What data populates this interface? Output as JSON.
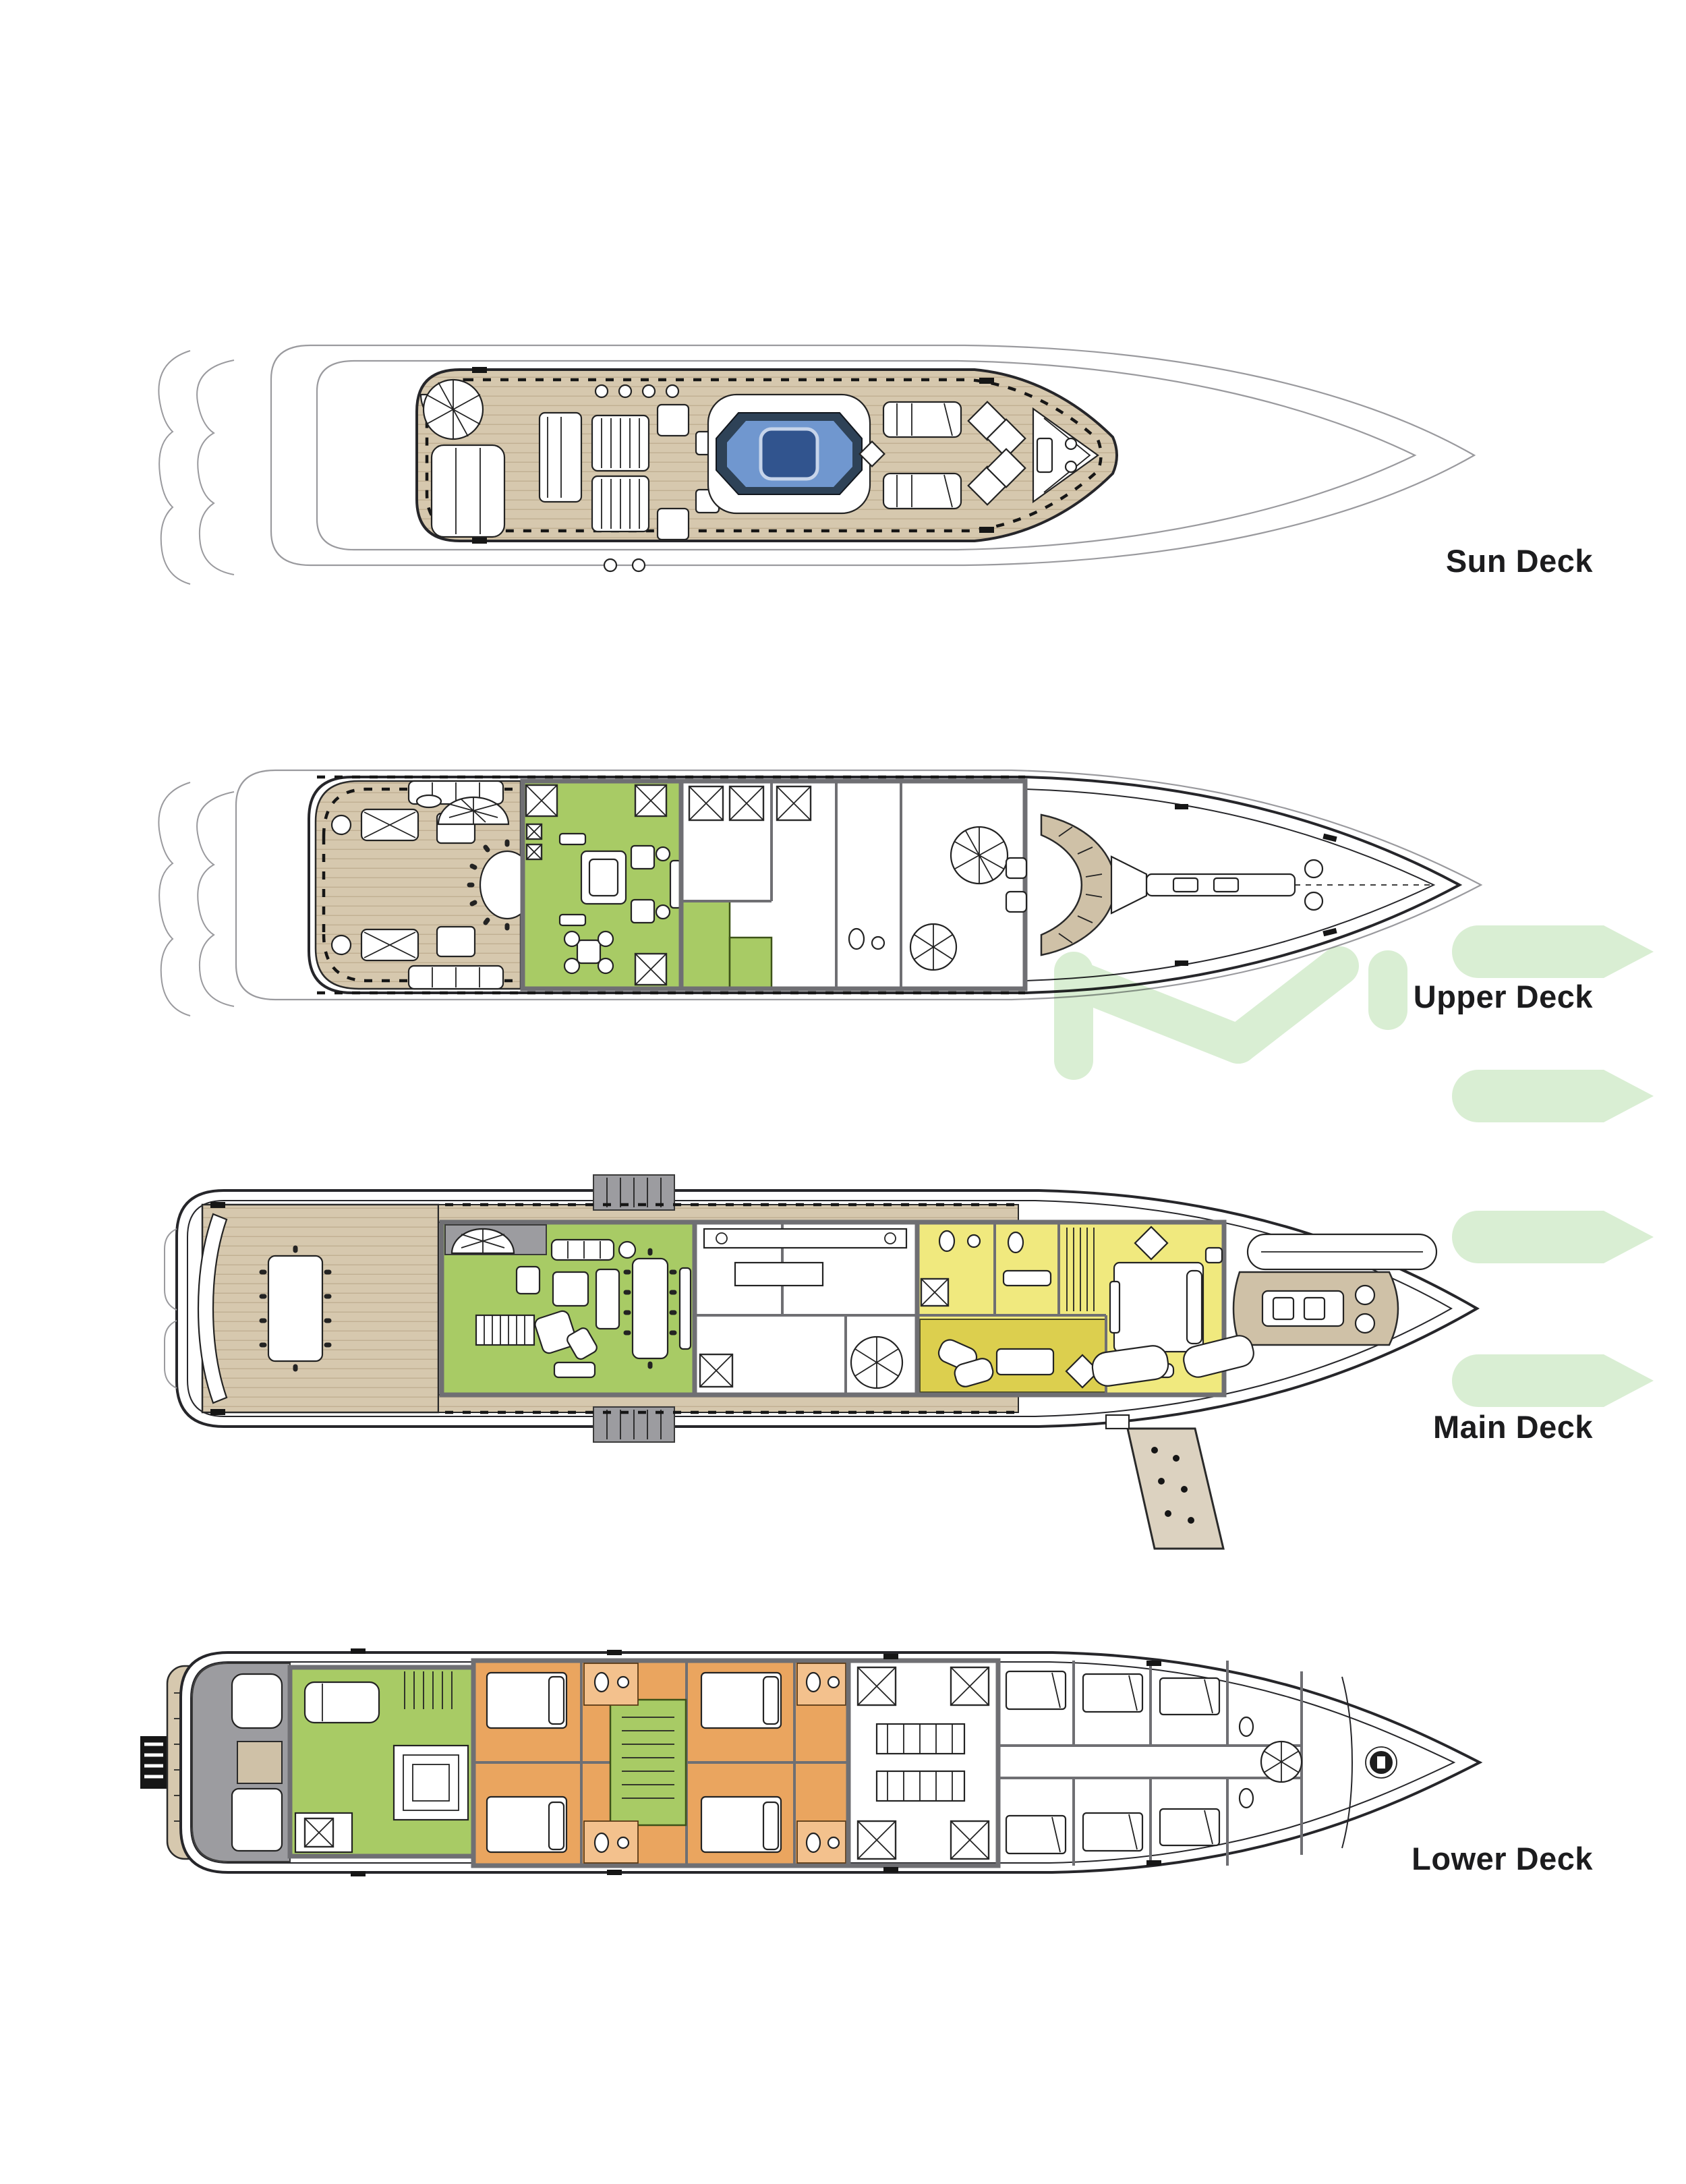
{
  "page": {
    "background_color": "#ffffff",
    "description": "Superyacht general arrangement – four stacked top-view deck plans, bow pointing right"
  },
  "decks": [
    {
      "id": "sun-deck",
      "label": "Sun Deck"
    },
    {
      "id": "upper-deck",
      "label": "Upper Deck"
    },
    {
      "id": "main-deck",
      "label": "Main Deck"
    },
    {
      "id": "lower-deck",
      "label": "Lower Deck"
    }
  ],
  "watermark": {
    "visible_letters": "ME",
    "color": "#d9eed3"
  },
  "legend_colors": {
    "teak_deck": "#d6c8ae",
    "guest_lounge_green": "#a8cb65",
    "owner_suite_yellow": "#f0e97e",
    "owner_study_mustard": "#dccf4e",
    "guest_cabin_orange": "#eaa55f",
    "jacuzzi_blue": "#7097cf",
    "label_text": "#1c1c1e"
  }
}
